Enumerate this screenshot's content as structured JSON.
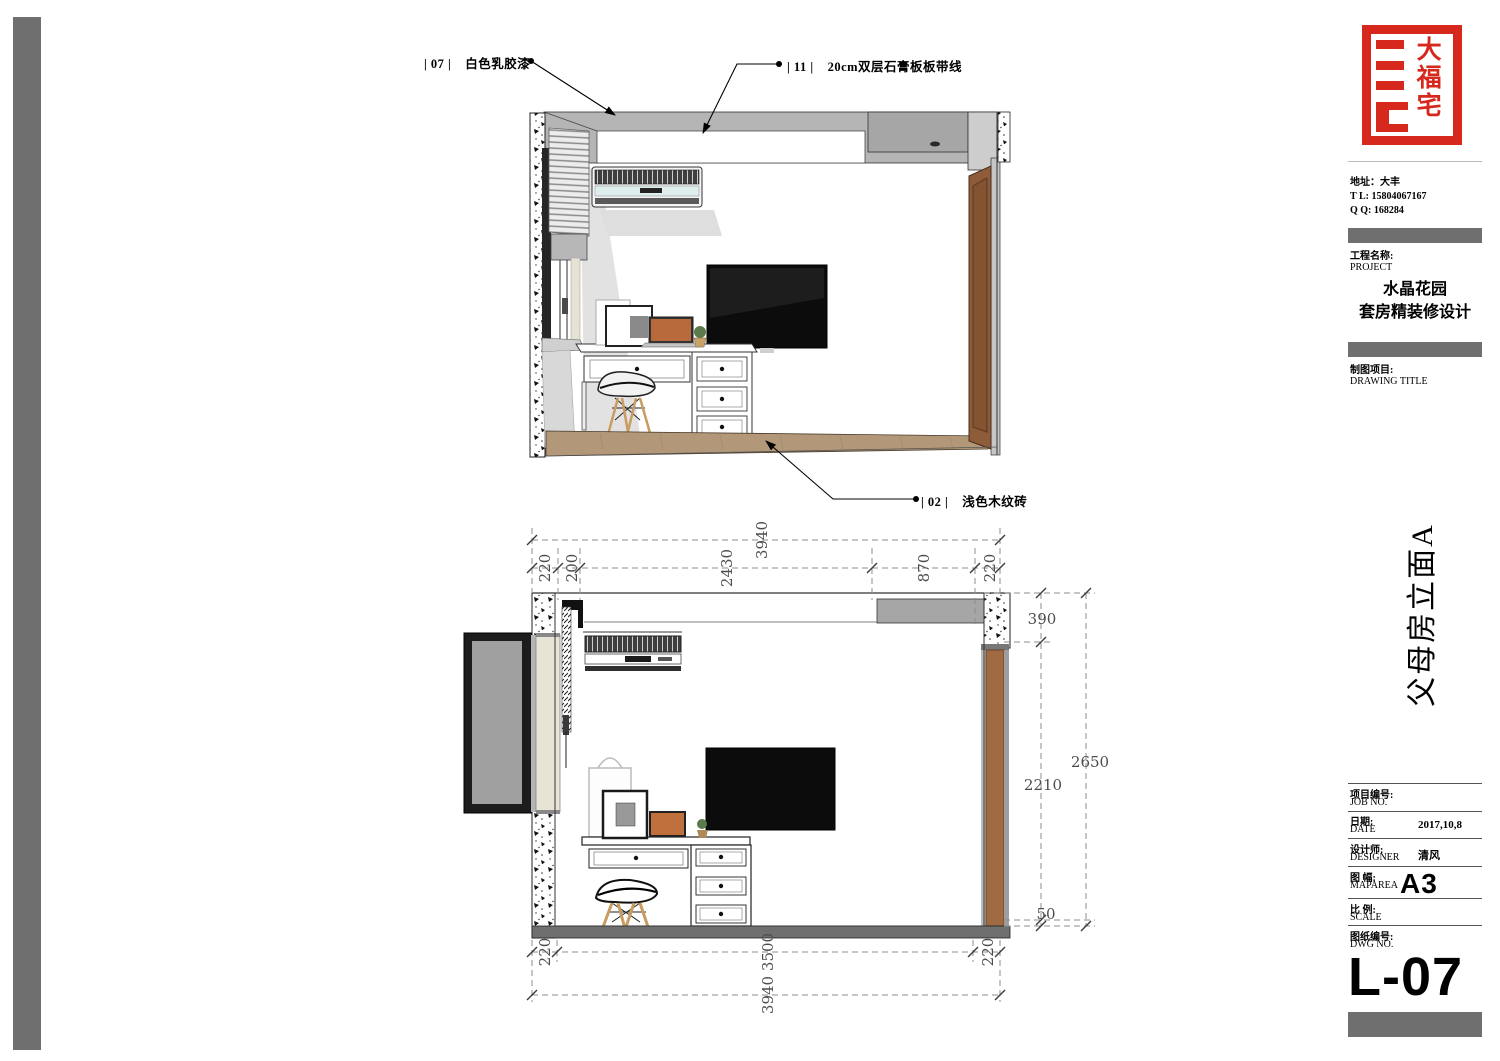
{
  "annotations": {
    "a07": {
      "code": "| 07 |",
      "label": "白色乳胶漆"
    },
    "a11": {
      "code": "| 11 |",
      "label": "20cm双层石膏板板带线"
    },
    "a02": {
      "code": "| 02 |",
      "label": "浅色木纹砖"
    }
  },
  "dims": {
    "top_overall": "3940",
    "top_segments": [
      "220",
      "200",
      "2430",
      "870",
      "220"
    ],
    "right_390": "390",
    "right_2210": "2210",
    "right_2650": "2650",
    "right_50": "50",
    "bottom_220_left": "220",
    "bottom_3500": "3500",
    "bottom_overall": "3940",
    "bottom_220_right": "220"
  },
  "titleblock": {
    "logo_text": "大福宅",
    "address_line1": "地址：大丰",
    "address_line2": "T  L:  15804067167",
    "address_line3": "Q  Q:  168284",
    "project_label_cn": "工程名称:",
    "project_label_en": "PROJECT",
    "project_name_line1": "水晶花园",
    "project_name_line2": "套房精装修设计",
    "drawing_label_cn": "制图项目:",
    "drawing_label_en": "DRAWING TITLE",
    "elevation_title": "父母房立面A",
    "rows": {
      "job": {
        "cn": "项目编号:",
        "en": "JOB NO.",
        "value": ""
      },
      "date": {
        "cn": "日期:",
        "en": "DATE",
        "value": "2017,10,8"
      },
      "designer": {
        "cn": "设计师:",
        "en": "DESIGNER",
        "value": "清风"
      },
      "maparea": {
        "cn": "图 幅:",
        "en": "MAPAREA",
        "value": "A3"
      },
      "scale": {
        "cn": "比 例:",
        "en": "SCALE",
        "value": ""
      },
      "dwg": {
        "cn": "图纸编号:",
        "en": "DWG NO.",
        "value": ""
      }
    },
    "sheet_number": "L-07"
  },
  "colors": {
    "accent_red": "#d7281d",
    "bar_gray": "#6f6f6f",
    "ceiling_gray": "#b5b5b5",
    "bulkhead_gray": "#a6a6a6",
    "door_brown": "#8e5c38",
    "wardrobe_brown": "#a06a42",
    "floor_wood": "#b29878",
    "floor_band_gray": "#6f6f6f",
    "glass_gray": "#a0a0a0",
    "curtain_cream": "#e8e4d5",
    "tv_black": "#0c0c0c"
  }
}
